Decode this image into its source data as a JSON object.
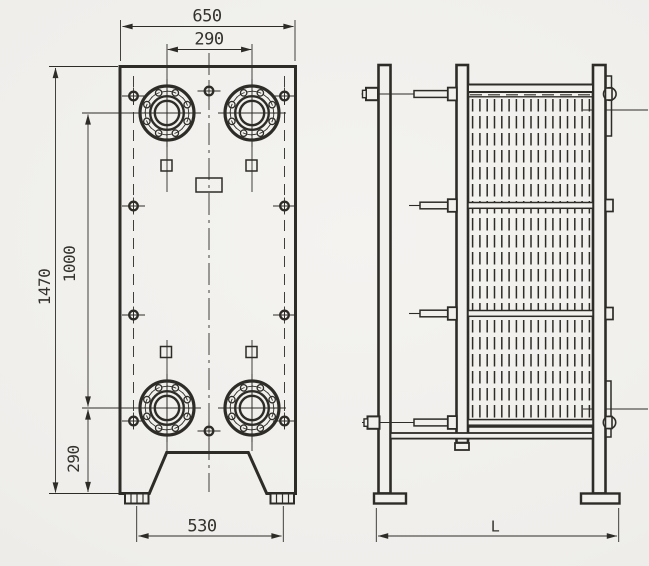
{
  "colors": {
    "background_center": "#f4f3f0",
    "background_edge": "#e7e6e2",
    "line": "#2e2c27",
    "text": "#34322c"
  },
  "drawing": {
    "type": "plate heat exchanger general arrangement",
    "front_view": {
      "dims": {
        "overall_width": "650",
        "port_spacing_horizontal": "290",
        "overall_height": "1470",
        "port_spacing_vertical": "1000",
        "port_to_base": "290",
        "foot_spacing": "530"
      },
      "features": {
        "ports": 4,
        "bolt_holes_per_port": 8,
        "tie_bolt_markers": 10,
        "feet": 2
      }
    },
    "side_view": {
      "dims": {
        "overall_length": "L"
      },
      "features": {
        "tie_bolt_levels": 4,
        "plate_pack_lines": 17
      }
    }
  }
}
